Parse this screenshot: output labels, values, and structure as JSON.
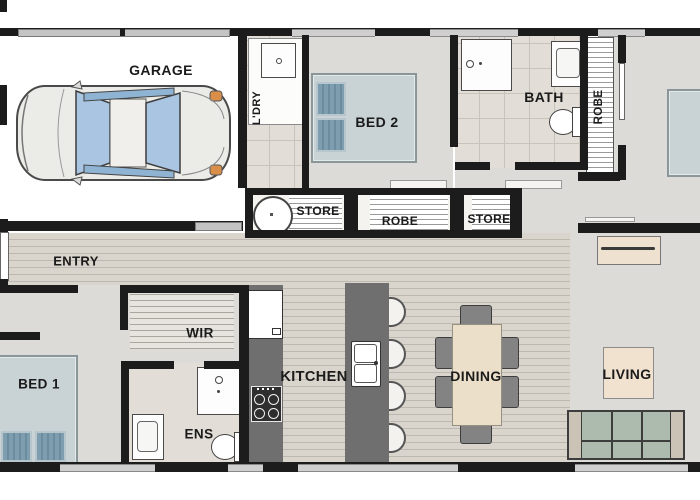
{
  "floorplan": {
    "rooms": {
      "garage": {
        "label": "GARAGE"
      },
      "laundry": {
        "label": "L'DRY"
      },
      "bed2": {
        "label": "BED 2"
      },
      "bath": {
        "label": "BATH"
      },
      "robe_master": {
        "label": "ROBE"
      },
      "store_hwc": {
        "label": "STORE"
      },
      "robe_hall": {
        "label": "ROBE"
      },
      "store_hall": {
        "label": "STORE"
      },
      "entry": {
        "label": "ENTRY"
      },
      "wir": {
        "label": "WIR"
      },
      "bed1": {
        "label": "BED 1"
      },
      "ensuite": {
        "label": "ENS"
      },
      "kitchen": {
        "label": "KITCHEN"
      },
      "dining": {
        "label": "DINING"
      },
      "living": {
        "label": "LIVING"
      }
    },
    "colors": {
      "wall": "#1c1c1c",
      "carpet": "#dcdbd7",
      "tile": "#e2ded7",
      "timber": "#d9d5cc",
      "bench": "#6f6f6f",
      "bed": "#c9d2d5",
      "pillow": "#7e9daf",
      "sofa": "#adbbae",
      "rug": "#f1e2d0",
      "table": "#ecdfca",
      "glass": "#aac6e2"
    }
  }
}
